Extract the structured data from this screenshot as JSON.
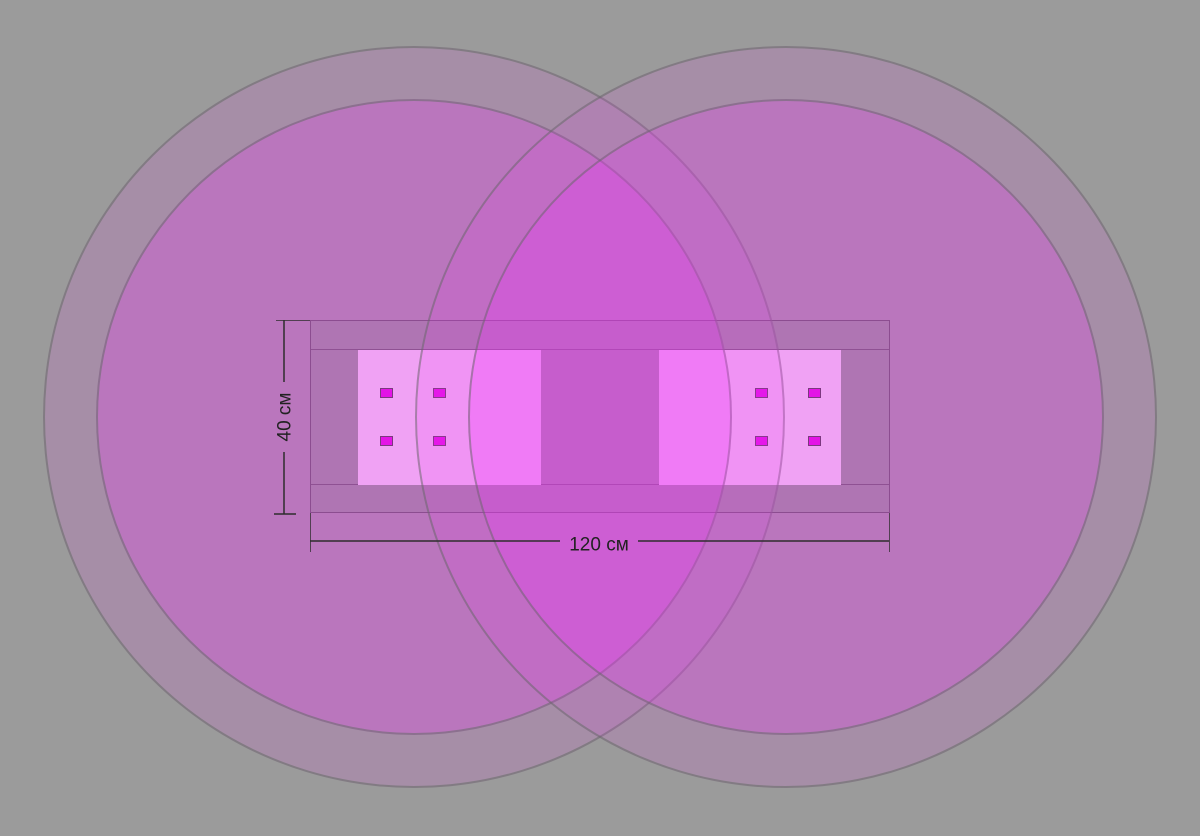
{
  "diagram": {
    "kind": "led-grow-light-coverage-diagram",
    "width_label": "120 см",
    "height_label": "40 см",
    "coverage_circles": [
      {
        "name": "left-lamp-coverage",
        "rings": 2
      },
      {
        "name": "right-lamp-coverage",
        "rings": 2
      }
    ],
    "fixture": {
      "board_count": 2,
      "leds_per_board": 4,
      "led_count_total": 8
    }
  },
  "colors": {
    "background": "#9b9b9b",
    "light-fill-outer": "rgba(240,55,250,0.13)",
    "light-fill-inner": "rgba(240,55,250,0.27)",
    "ring-stroke": "rgba(95,105,95,0.5)",
    "fixture-base": "#8a9a8a",
    "board": "#f0e1f0",
    "led": "#dc00dc",
    "led-border": "#3a3a3a",
    "dim-line": "rgba(45,45,45,0.75)",
    "dim-text": "#222222"
  }
}
